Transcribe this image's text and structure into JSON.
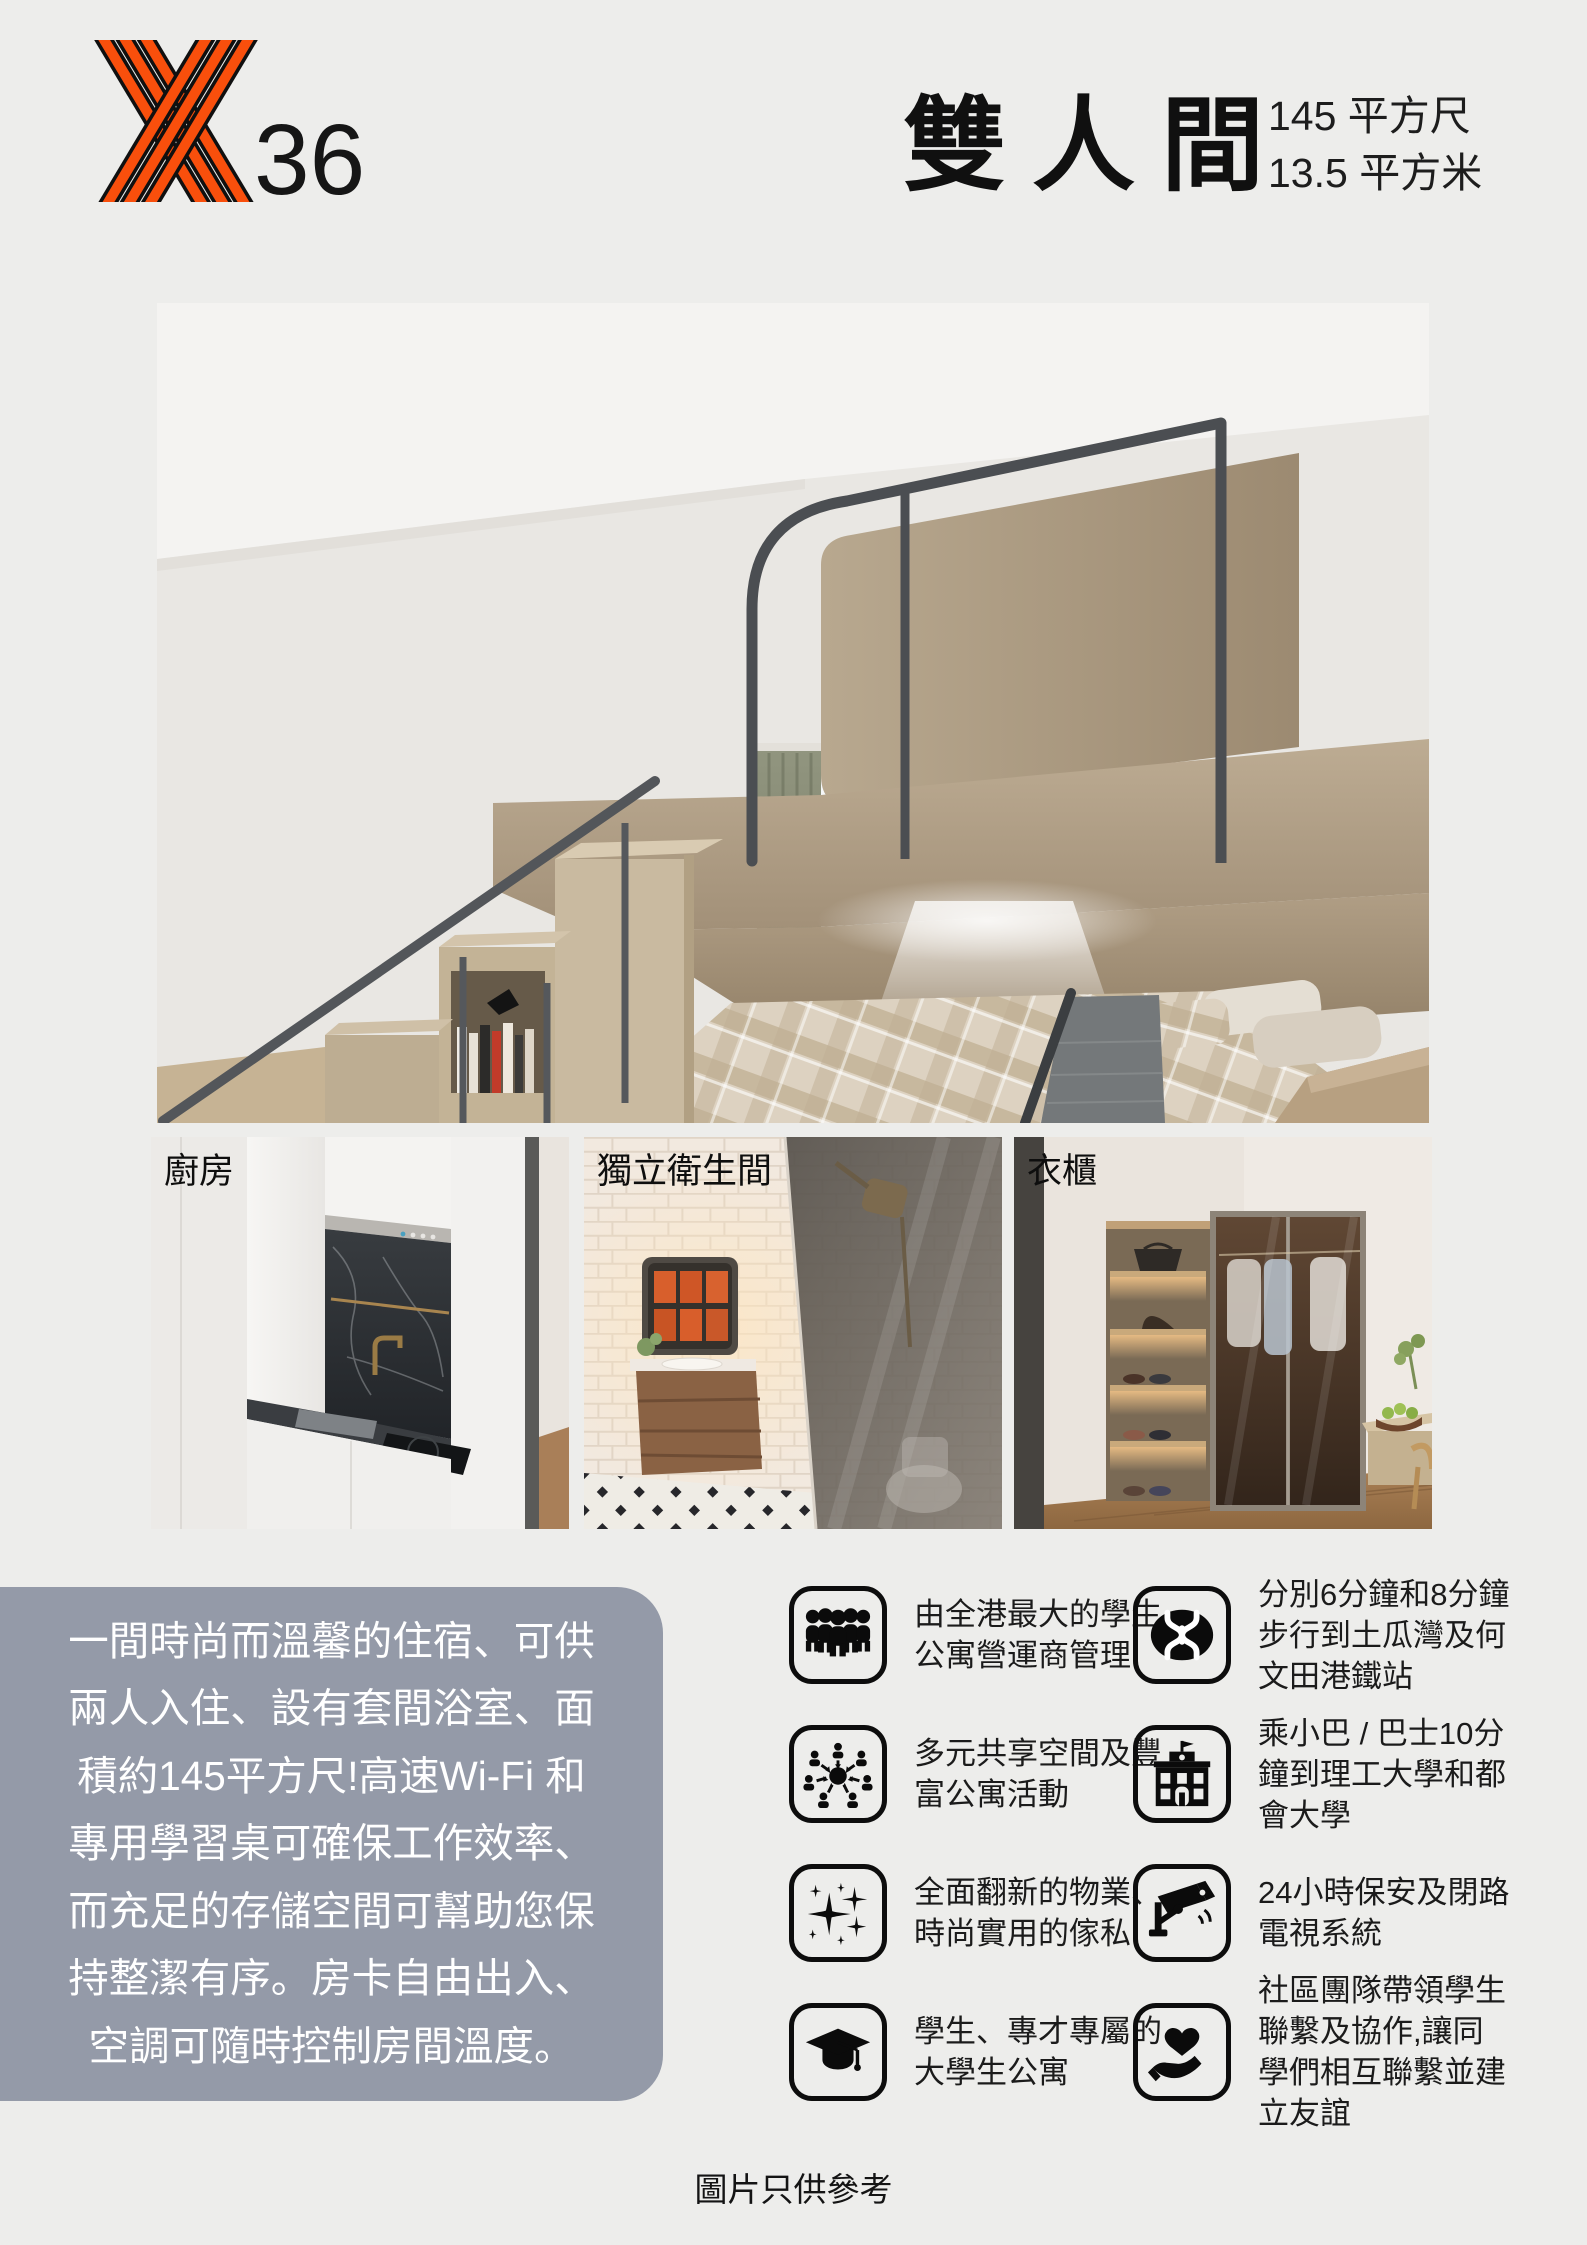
{
  "colors": {
    "page_bg": "#EDEDEB",
    "accent_orange": "#F94F0C",
    "description_bg": "#949AA8",
    "text": "#151515",
    "description_text": "#FFFFFF"
  },
  "header": {
    "logo_number": "36",
    "logo_mark": "y36-striped-y-icon",
    "title": "雙人間",
    "area_sqft": "145 平方尺",
    "area_sqm": "13.5 平方米"
  },
  "photos": {
    "main": {
      "name": "loft-room-photo"
    },
    "kitchen": {
      "label": "廚房"
    },
    "bathroom": {
      "label": "獨立衛生間"
    },
    "wardrobe": {
      "label": "衣櫃"
    }
  },
  "description": {
    "text": "一間時尚而溫馨的住宿、可供\n兩人入住、設有套間浴室、面\n積約145平方尺!高速Wi-Fi 和\n專用學習桌可確保工作效率、\n而充足的存儲空間可幫助您保\n持整潔有序。房卡自由出入、\n空調可隨時控制房間溫度。"
  },
  "features": {
    "column1": [
      {
        "icon": "people-group-icon",
        "text": "由全港最大的學生\n公寓營運商管理"
      },
      {
        "icon": "community-share-icon",
        "text": "多元共享空間及豐\n富公寓活動"
      },
      {
        "icon": "sparkles-icon",
        "text": "全面翻新的物業、\n時尚實用的傢私"
      },
      {
        "icon": "graduation-cap-icon",
        "text": "學生、專才專屬的\n大學生公寓"
      }
    ],
    "column2": [
      {
        "icon": "mtr-icon",
        "text": "分別6分鐘和8分鐘\n步行到土瓜灣及何\n文田港鐵站"
      },
      {
        "icon": "school-building-icon",
        "text": "乘小巴 / 巴士10分\n鐘到理工大學和都\n會大學"
      },
      {
        "icon": "cctv-camera-icon",
        "text": "24小時保安及閉路\n電視系統"
      },
      {
        "icon": "heart-hand-icon",
        "text": "社區團隊帶領學生\n聯繫及協作,讓同\n學們相互聯繫並建\n立友誼"
      }
    ]
  },
  "footer": {
    "note": "圖片只供參考"
  }
}
